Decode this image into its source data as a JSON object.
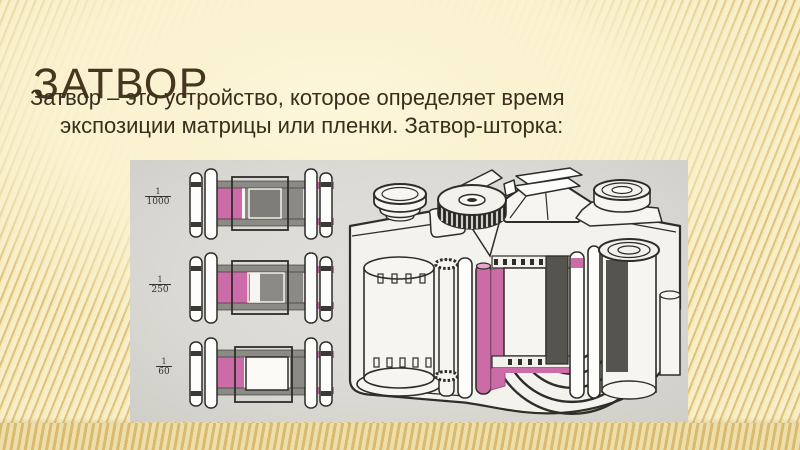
{
  "slide": {
    "title": "ЗАТВОР",
    "body": {
      "line1": "Затвор – это устройство, которое определяет время",
      "line2": "экспозиции матрицы или пленки. Затвор-шторка:"
    },
    "figure": {
      "shutter_speeds": [
        {
          "numerator": "1",
          "denominator": "1000"
        },
        {
          "numerator": "1",
          "denominator": "250"
        },
        {
          "numerator": "1",
          "denominator": "60"
        }
      ]
    },
    "colors": {
      "background": "#f7edc3",
      "stripe": "#dfc27b",
      "title_text": "#46351f",
      "body_text": "#3b2d1d",
      "photo_background": "#dbdad5",
      "curtain_pink": "#cb6ca9",
      "curtain_gray": "#8b8a85",
      "line_art": "#2e2d2a"
    }
  }
}
